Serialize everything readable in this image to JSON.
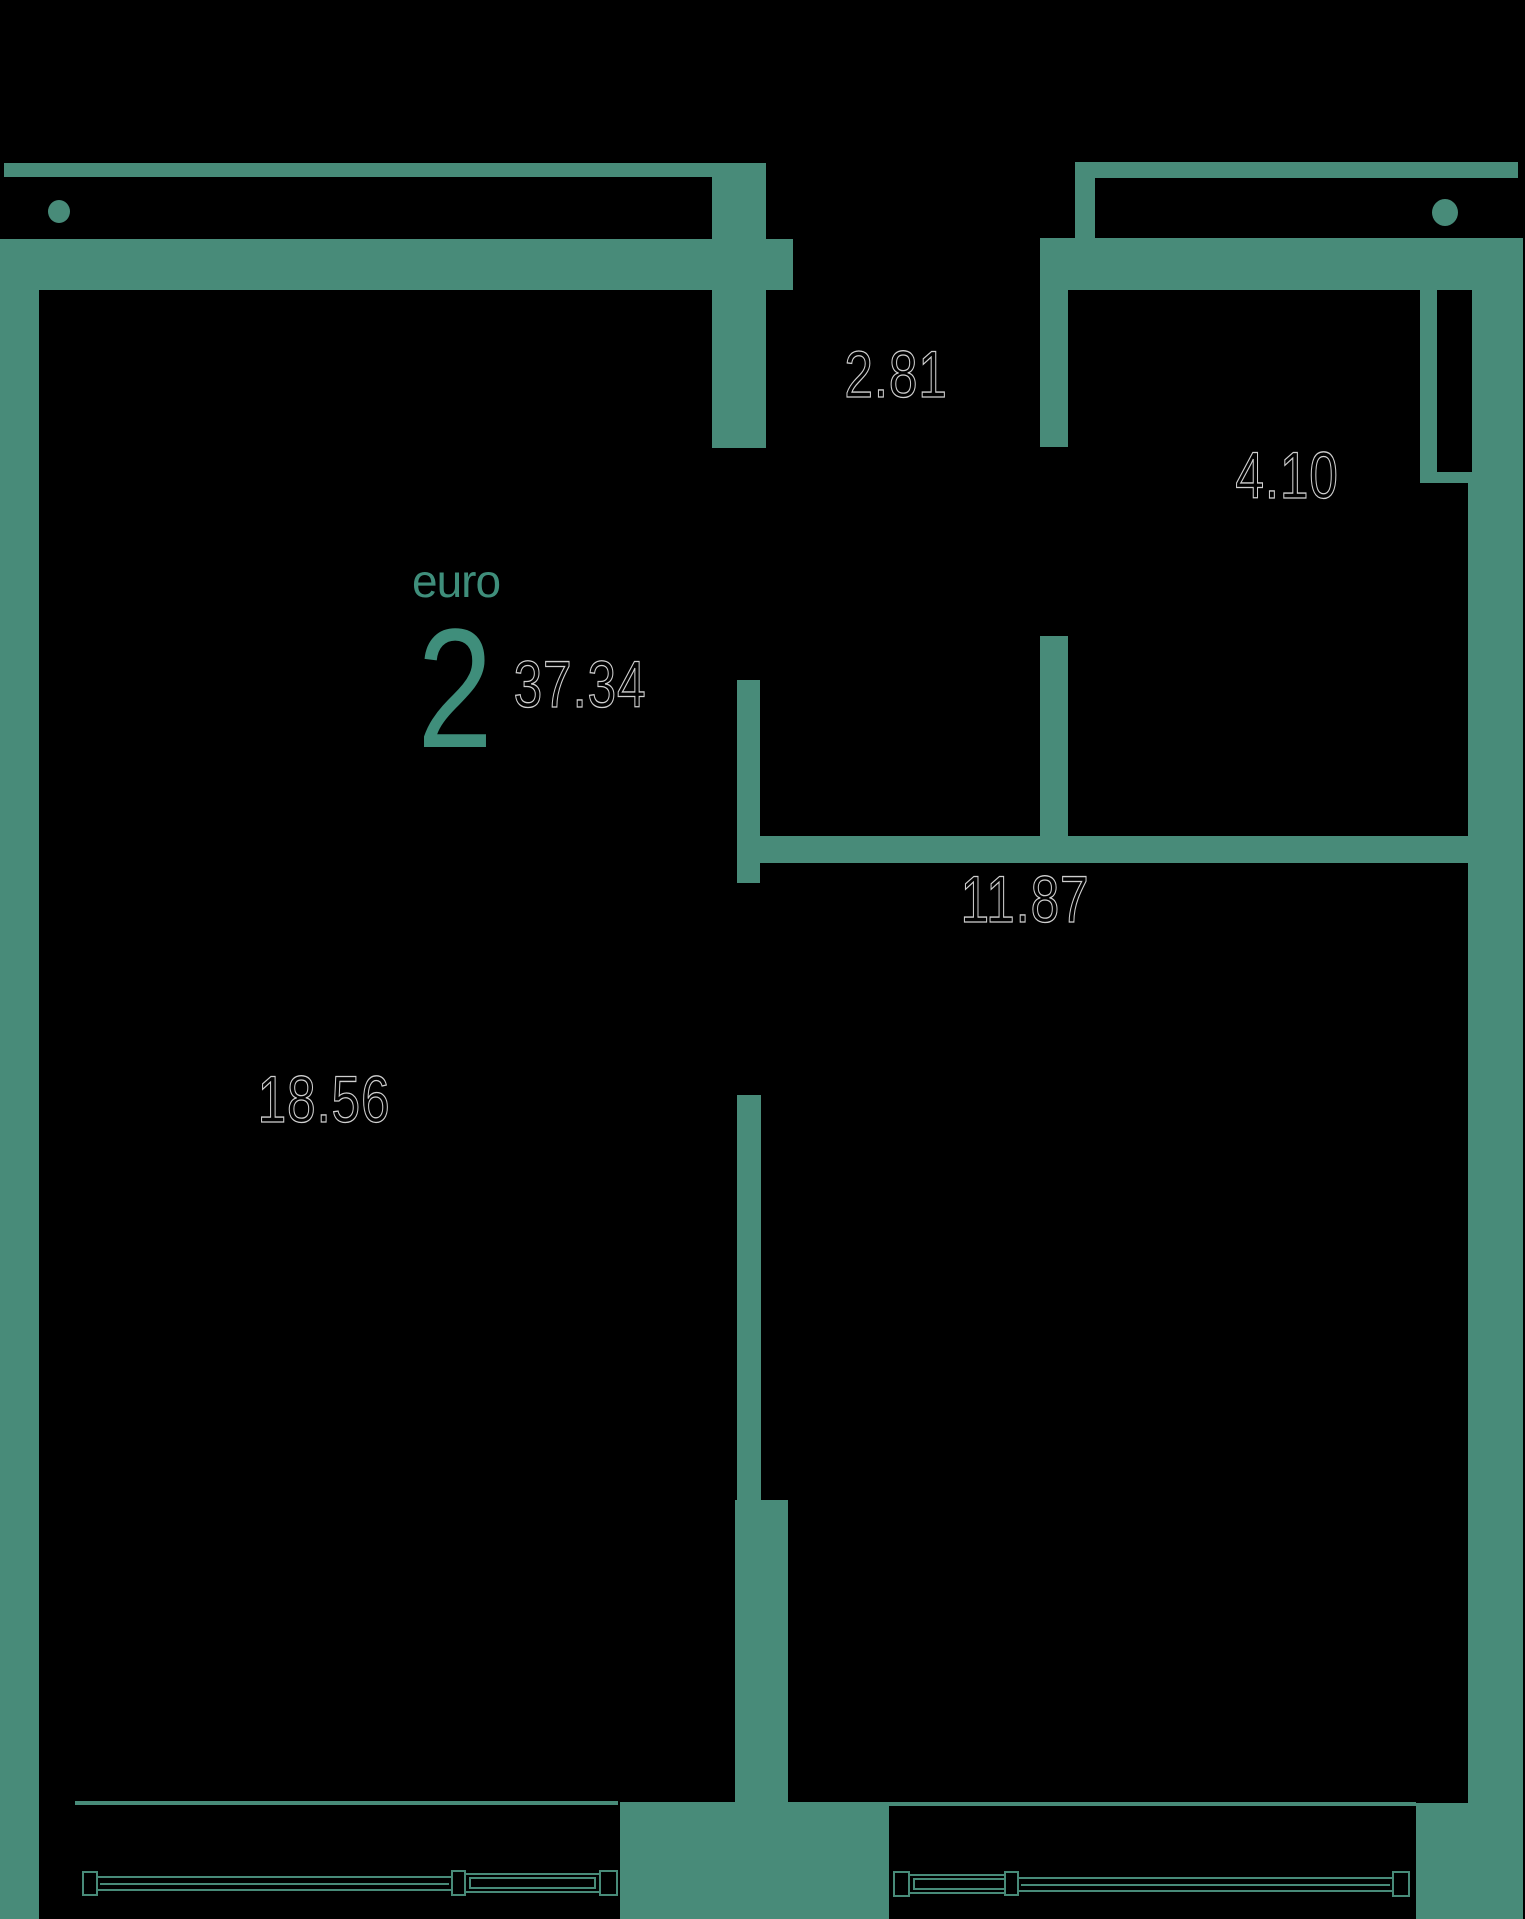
{
  "plan": {
    "brand": {
      "label": "euro",
      "number": "2"
    },
    "total_area": "37.34",
    "rooms": [
      {
        "position": "entry-hall-top-middle",
        "area": "2.81"
      },
      {
        "position": "bathroom-top-right",
        "area": "4.10"
      },
      {
        "position": "room-right",
        "area": "11.87"
      },
      {
        "position": "room-left",
        "area": "18.56"
      }
    ],
    "colors": {
      "background": "#000000",
      "wall": "#488B79",
      "brand_text": "#3F8E7B",
      "area_label_outline": "#CFCFCF"
    }
  }
}
